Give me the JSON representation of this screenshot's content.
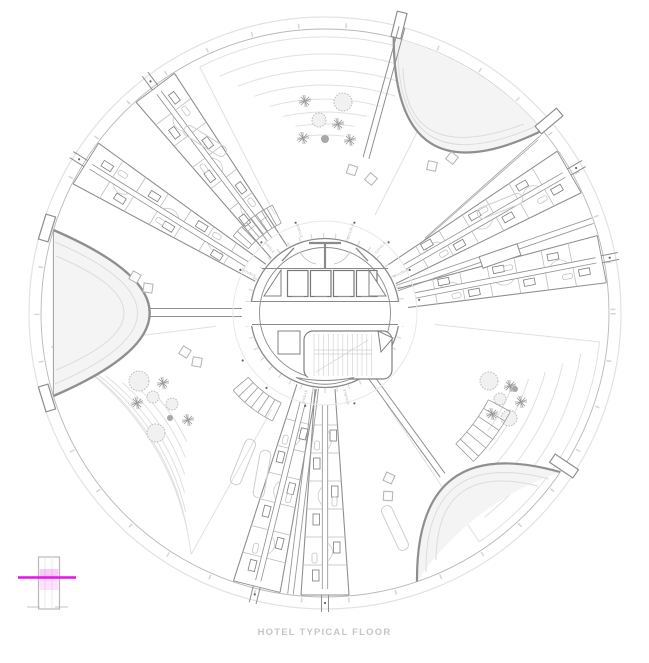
{
  "caption": "HOTEL TYPICAL FLOOR",
  "core": {
    "labels": [
      {
        "text": "DOUBLE"
      },
      {
        "text": "SINGLE"
      },
      {
        "text": "SINGLE"
      },
      {
        "text": "DOUBLE"
      },
      {
        "text": "SINGLE"
      },
      {
        "text": "DOUBLE"
      },
      {
        "text": "DOUBLE"
      },
      {
        "text": "SINGLE"
      }
    ]
  },
  "marker": {
    "accent_color": "#e712e7"
  },
  "drawing_colors": {
    "line_dark": "#8a8a8a",
    "line_mid": "#b5b5b5",
    "line_light": "#dddddd",
    "caption_color": "#c6c6c9"
  },
  "icons": {
    "round_tree": "round-tree-icon",
    "star_tree": "star-tree-icon",
    "level_marker": "floor-level-marker-icon"
  }
}
